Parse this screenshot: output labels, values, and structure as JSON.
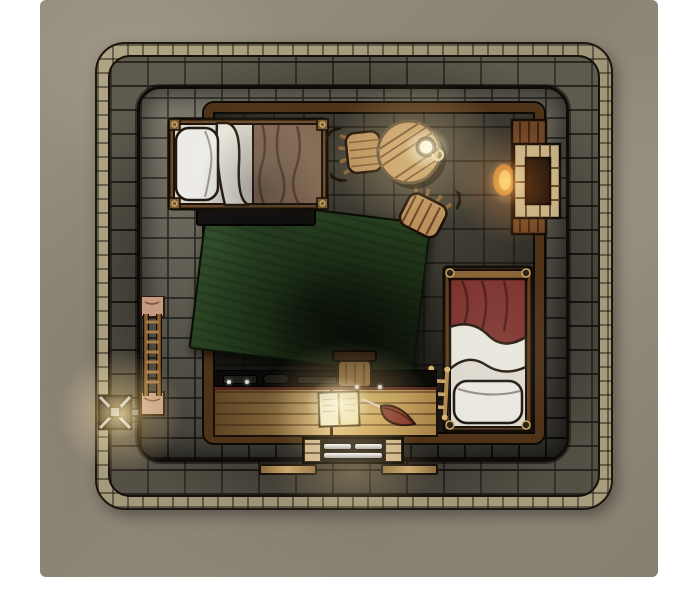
{
  "map": {
    "title": "Stone tower bedroom - top-down battle map",
    "style": "hand-drawn fantasy VTT map",
    "room_label": "Bedroom with stone floor",
    "ground_label": "Plaster ground around tower"
  },
  "objects": {
    "ground": {
      "label": "Plaster courtyard ground"
    },
    "building": {
      "label": "Outer stone-brick tower wall"
    },
    "innerWall": {
      "label": "Inner stone wall ring"
    },
    "room": {
      "label": "Bedroom stone-tile floor with wooden trim"
    },
    "bedBrown": {
      "label": "Bed with brown blanket and white pillow"
    },
    "underBedBox": {
      "label": "Storage box under bed"
    },
    "bedRed": {
      "label": "Bed with red blanket and white pillow"
    },
    "tableRound": {
      "label": "Round wooden table"
    },
    "mug": {
      "label": "Mug on table"
    },
    "chairTop": {
      "label": "Wooden chair at table"
    },
    "chairSide": {
      "label": "Wooden chair at table (tilted)"
    },
    "fireplace": {
      "label": "Stone fireplace in right wall"
    },
    "rug": {
      "label": "Large green rug"
    },
    "ladderWall": {
      "label": "Ladder against left wall"
    },
    "ladderSmall": {
      "label": "Small ladder beside red bed"
    },
    "toolShelf": {
      "label": "Dark shelf with iron tools"
    },
    "desk": {
      "label": "Long wooden writing desk"
    },
    "book": {
      "label": "Open book on desk"
    },
    "quill": {
      "label": "Red quill pen"
    },
    "deskChair": {
      "label": "Chair at writing desk"
    },
    "windowBottom": {
      "label": "Barred window in south wall"
    },
    "ledgeLeft": {
      "label": "Wooden ledge outside south wall"
    },
    "ledgeRight": {
      "label": "Wooden ledge outside south wall"
    },
    "torch": {
      "label": "Iron torch sconce on west wall"
    }
  },
  "colors": {
    "plaster": "#8e8677",
    "trim": "#a89e7e",
    "brick": "#4a463d",
    "stone": "#6b675c",
    "floor": "#3a372f",
    "wood": "#c9a258",
    "wood-dark": "#4e3319",
    "rug-green": "#2c4523",
    "blanket-brown": "#7d6450",
    "blanket-red": "#7d332e",
    "cloth-white": "#e9e7e0",
    "glow-warm": "#ffd98c",
    "flame": "#e07a28"
  },
  "lights": [
    {
      "name": "torch-glow",
      "hex": "#ffd98c"
    },
    {
      "name": "table-candle-glow",
      "hex": "#ffe2a8"
    },
    {
      "name": "fireplace-glow",
      "hex": "#ff9a3c"
    },
    {
      "name": "desk-lantern-glow",
      "hex": "#ffe2a8"
    },
    {
      "name": "window-light-spill",
      "hex": "#ffd98c"
    }
  ]
}
